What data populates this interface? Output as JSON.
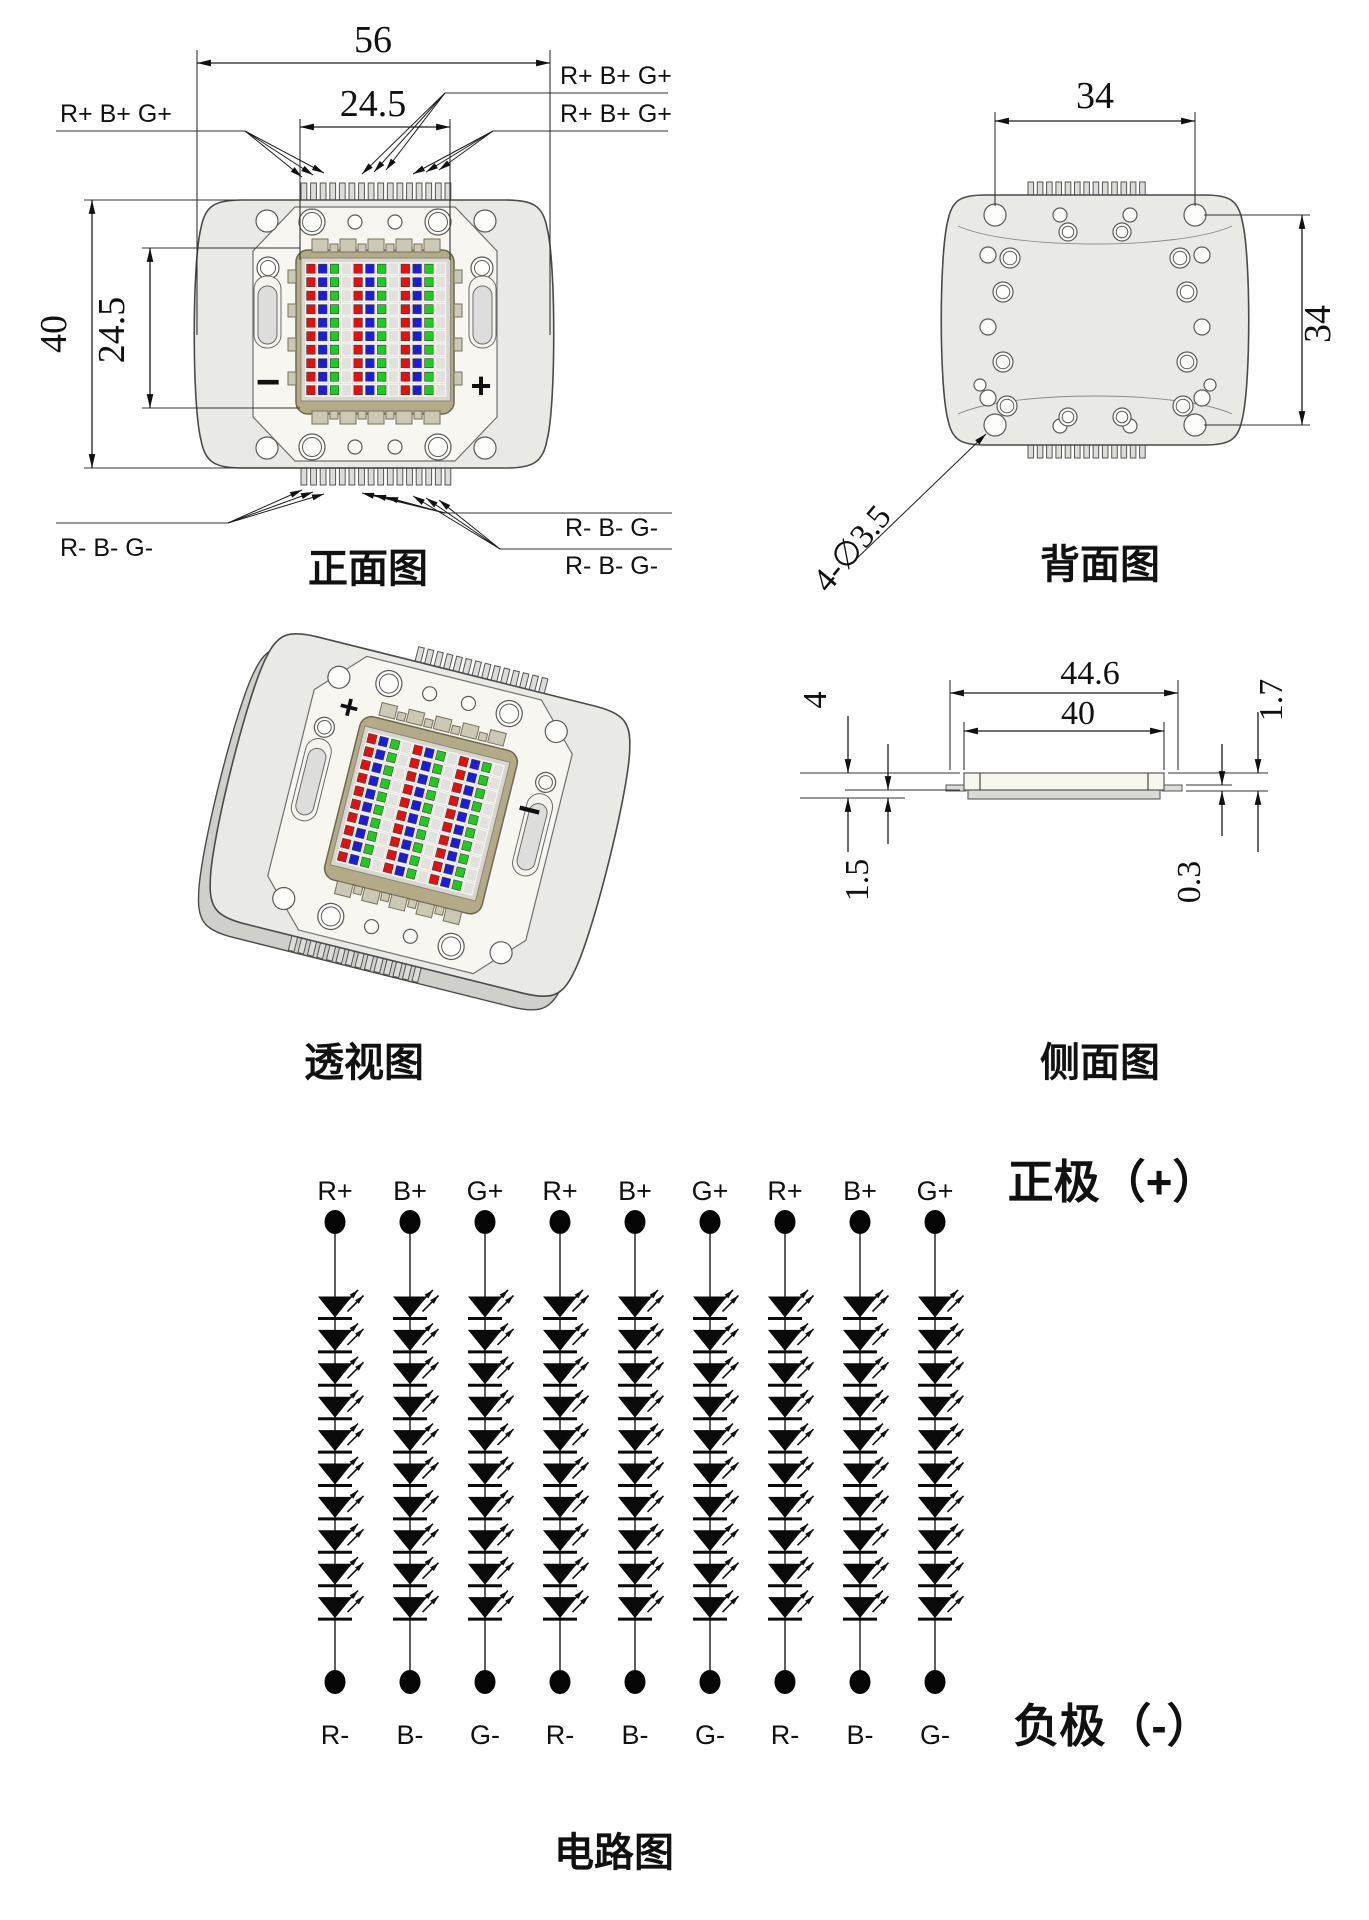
{
  "front_view": {
    "caption": "正面图",
    "dims": {
      "overall_width": "56",
      "emitter_width": "24.5",
      "overall_height": "40",
      "emitter_height": "24.5"
    },
    "polarity": {
      "minus": "−",
      "plus": "+"
    },
    "leads": {
      "top_left": "R+ B+ G+",
      "top_right_1": "R+ B+ G+",
      "top_right_2": "R+ B+ G+",
      "bottom_left": "R- B- G-",
      "bottom_right_1": "R- B- G-",
      "bottom_right_2": "R- B- G-"
    }
  },
  "back_view": {
    "caption": "背面图",
    "dims": {
      "hole_span_h": "34",
      "hole_span_v": "34"
    },
    "hole_note": "4-∅3.5"
  },
  "perspective_view": {
    "caption": "透视图",
    "polarity": {
      "plus": "+",
      "minus": "−"
    }
  },
  "side_view": {
    "caption": "侧面图",
    "dims": {
      "overall_width": "44.6",
      "body_width": "40",
      "total_height": "4",
      "base_height": "1.5",
      "body_height": "1.7",
      "pin_thickness": "0.3"
    }
  },
  "circuit": {
    "caption": "电路图",
    "positive_label": "正极（+）",
    "negative_label": "负极（-）",
    "top_terminals": [
      "R+",
      "B+",
      "G+",
      "R+",
      "B+",
      "G+",
      "R+",
      "B+",
      "G+"
    ],
    "bottom_terminals": [
      "R-",
      "B-",
      "G-",
      "R-",
      "B-",
      "G-",
      "R-",
      "B-",
      "G-"
    ],
    "strings": 9,
    "leds_per_string": 10
  },
  "led_colors": {
    "red": "#e60f0f",
    "blue": "#1c1cdd",
    "green": "#1ecb1e"
  }
}
